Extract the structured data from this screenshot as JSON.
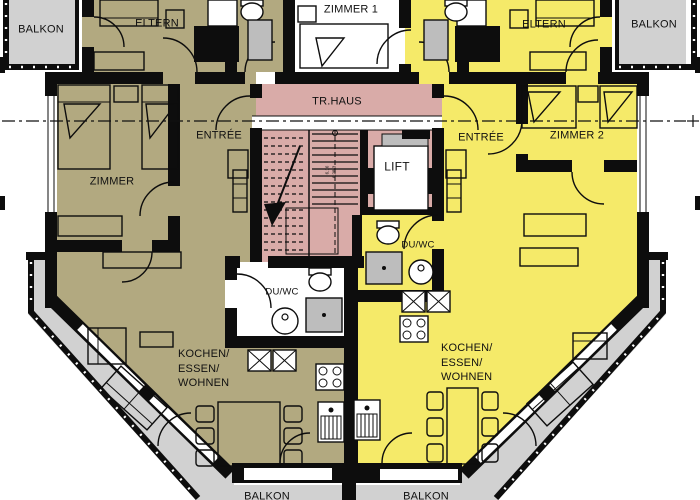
{
  "title": "Grundriss / apartment floor plan",
  "colors": {
    "wall": "#0d0d0d",
    "apartment_left": "#b2a980",
    "apartment_right": "#f5ea69",
    "stairwell": "#d9aba8",
    "balcony": "#d1d1d1",
    "shower": "#bdbdbd",
    "lift_door": "#bdbdbd"
  },
  "labels": {
    "balkon_top_left": "BALKON",
    "eltern_left": "ELTERN",
    "zimmer_1": "ZIMMER 1",
    "eltern_right": "ELTERN",
    "balkon_top_right": "BALKON",
    "tr_haus": "TR.HAUS",
    "entree_left": "ENTRÉE",
    "entree_right": "ENTRÉE",
    "zimmer_2": "ZIMMER 2",
    "zimmer_left": "ZIMMER",
    "lift": "LIFT",
    "du_wc_right": "DU/WC",
    "du_wc_left": "DU/WC",
    "kochen_left_1": "KOCHEN/",
    "kochen_left_2": "ESSEN/",
    "kochen_left_3": "WOHNEN",
    "kochen_right_1": "KOCHEN/",
    "kochen_right_2": "ESSEN/",
    "kochen_right_3": "WOHNEN",
    "balkon_bottom_left": "BALKON",
    "balkon_bottom_right": "BALKON",
    "stair_note_a": "6.16",
    "stair_note_b": "6.28.3"
  },
  "fixtures": [
    "bed-icon",
    "nightstand-icon",
    "toilet-icon",
    "washbasin-icon",
    "shower-icon",
    "stove-icon",
    "kitchen-sink-icon",
    "tall-cabinet-icon",
    "sofa-icon",
    "armchair-icon",
    "dining-table-icon",
    "chair-icon",
    "stairs-icon",
    "stair-arrow-icon",
    "lift-icon",
    "door-swing-icon",
    "window-icon",
    "railing-dots-icon",
    "section-line-icon",
    "wardrobe-icon",
    "sideboard-icon",
    "shaft-icon"
  ]
}
